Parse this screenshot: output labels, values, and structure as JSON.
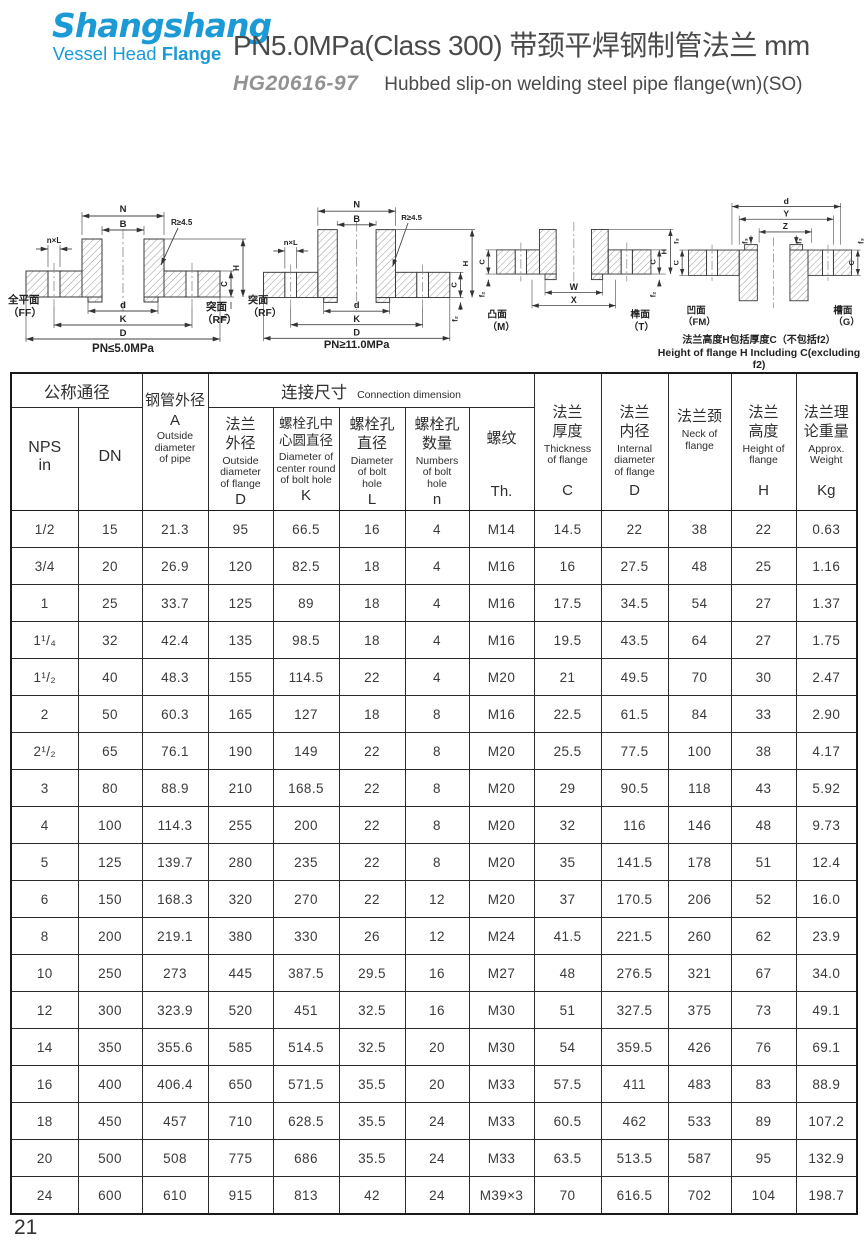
{
  "page": {
    "number": "21"
  },
  "header": {
    "logo_line1": "Shangshang",
    "logo_line2_a": "Vessel Head ",
    "logo_line2_b": "Flange",
    "logo_color": "#1b9ad6",
    "title": "PN5.0MPa(Class 300) 带颈平焊钢制管法兰  mm",
    "standard": "HG20616-97",
    "subtitle": "Hubbed slip-on welding steel pipe flange(wn)(SO)"
  },
  "figures": {
    "fig1": {
      "dim_N": "N",
      "dim_B": "B",
      "dim_nxL": "n×L",
      "dim_R": "R≥4.5",
      "dim_d": "d",
      "dim_K": "K",
      "dim_D": "D",
      "dim_C": "C",
      "dim_H": "H",
      "dim_f": "f₁",
      "face_left_cn": "全平面",
      "face_left_code": "（FF）",
      "face_right_cn": "突面",
      "face_right_code": "（RF）",
      "caption": "PN≤5.0MPa"
    },
    "fig2": {
      "dim_N": "N",
      "dim_B": "B",
      "dim_nxL": "n×L",
      "dim_R": "R≥4.5",
      "dim_d": "d",
      "dim_K": "K",
      "dim_D": "D",
      "dim_C": "C",
      "dim_H": "H",
      "dim_f": "f₂",
      "face_left_cn": "突面",
      "face_left_code": "（RF）",
      "caption": "PN≥11.0MPa"
    },
    "fig3": {
      "dim_W": "W",
      "dim_X": "X",
      "dim_C": "C",
      "dim_H": "H",
      "dim_f": "f₂",
      "face_left_cn": "凸面",
      "face_left_code": "（M）",
      "face_right_cn": "榫面",
      "face_right_code": "（T）"
    },
    "fig4": {
      "dim_d": "d",
      "dim_Y": "Y",
      "dim_Z": "Z",
      "dim_C": "C",
      "dim_f": "f₃",
      "face_left_cn": "凹面",
      "face_left_code": "（FM）",
      "face_right_cn": "槽面",
      "face_right_code": "（G）",
      "note_cn": "法兰高度H包括厚度C（不包括f2）",
      "note_en": "Height of flange H Including C(excluding f2)"
    }
  },
  "table": {
    "group_nominal": "公称通径",
    "group_connection_cn": "连接尺寸",
    "group_connection_en": "Connection dimension",
    "nps_l1": "NPS",
    "nps_l2": "in",
    "dn": "DN",
    "pipe_cn": "钢管外径",
    "pipe_sym": "A",
    "pipe_en": "Outside\ndiameter\nof pipe",
    "flange_od_cn": "法兰\n外径",
    "flange_od_en": "Outside\ndiameter\nof flange",
    "flange_od_sym": "D",
    "bolt_circle_cn": "螺栓孔中\n心圆直径",
    "bolt_circle_en": "Diameter of\ncenter round\nof bolt hole",
    "bolt_circle_sym": "K",
    "bolt_hole_cn": "螺栓孔\n直径",
    "bolt_hole_en": "Diameter\nof bolt\nhole",
    "bolt_hole_sym": "L",
    "bolt_num_cn": "螺栓孔\n数量",
    "bolt_num_en": "Numbers\nof bolt\nhole",
    "bolt_num_sym": "n",
    "thread_cn": "螺纹",
    "thread_sym": "Th.",
    "thickness_cn": "法兰\n厚度",
    "thickness_en": "Thickness\nof flange",
    "thickness_sym": "C",
    "inner_cn": "法兰\n内径",
    "inner_en": "Internal\ndiameter\nof flange",
    "inner_sym": "D",
    "neck_cn": "法兰颈",
    "neck_en": "Neck of\nflange",
    "height_cn": "法兰\n高度",
    "height_en": "Height of\nflange",
    "height_sym": "H",
    "weight_cn": "法兰理\n论重量",
    "weight_en": "Approx.\nWeight",
    "weight_sym": "Kg",
    "rows": [
      [
        "1/2",
        "15",
        "21.3",
        "95",
        "66.5",
        "16",
        "4",
        "M14",
        "14.5",
        "22",
        "38",
        "22",
        "0.63"
      ],
      [
        "3/4",
        "20",
        "26.9",
        "120",
        "82.5",
        "18",
        "4",
        "M16",
        "16",
        "27.5",
        "48",
        "25",
        "1.16"
      ],
      [
        "1",
        "25",
        "33.7",
        "125",
        "89",
        "18",
        "4",
        "M16",
        "17.5",
        "34.5",
        "54",
        "27",
        "1.37"
      ],
      [
        "1¹/₄",
        "32",
        "42.4",
        "135",
        "98.5",
        "18",
        "4",
        "M16",
        "19.5",
        "43.5",
        "64",
        "27",
        "1.75"
      ],
      [
        "1¹/₂",
        "40",
        "48.3",
        "155",
        "114.5",
        "22",
        "4",
        "M20",
        "21",
        "49.5",
        "70",
        "30",
        "2.47"
      ],
      [
        "2",
        "50",
        "60.3",
        "165",
        "127",
        "18",
        "8",
        "M16",
        "22.5",
        "61.5",
        "84",
        "33",
        "2.90"
      ],
      [
        "2¹/₂",
        "65",
        "76.1",
        "190",
        "149",
        "22",
        "8",
        "M20",
        "25.5",
        "77.5",
        "100",
        "38",
        "4.17"
      ],
      [
        "3",
        "80",
        "88.9",
        "210",
        "168.5",
        "22",
        "8",
        "M20",
        "29",
        "90.5",
        "118",
        "43",
        "5.92"
      ],
      [
        "4",
        "100",
        "114.3",
        "255",
        "200",
        "22",
        "8",
        "M20",
        "32",
        "116",
        "146",
        "48",
        "9.73"
      ],
      [
        "5",
        "125",
        "139.7",
        "280",
        "235",
        "22",
        "8",
        "M20",
        "35",
        "141.5",
        "178",
        "51",
        "12.4"
      ],
      [
        "6",
        "150",
        "168.3",
        "320",
        "270",
        "22",
        "12",
        "M20",
        "37",
        "170.5",
        "206",
        "52",
        "16.0"
      ],
      [
        "8",
        "200",
        "219.1",
        "380",
        "330",
        "26",
        "12",
        "M24",
        "41.5",
        "221.5",
        "260",
        "62",
        "23.9"
      ],
      [
        "10",
        "250",
        "273",
        "445",
        "387.5",
        "29.5",
        "16",
        "M27",
        "48",
        "276.5",
        "321",
        "67",
        "34.0"
      ],
      [
        "12",
        "300",
        "323.9",
        "520",
        "451",
        "32.5",
        "16",
        "M30",
        "51",
        "327.5",
        "375",
        "73",
        "49.1"
      ],
      [
        "14",
        "350",
        "355.6",
        "585",
        "514.5",
        "32.5",
        "20",
        "M30",
        "54",
        "359.5",
        "426",
        "76",
        "69.1"
      ],
      [
        "16",
        "400",
        "406.4",
        "650",
        "571.5",
        "35.5",
        "20",
        "M33",
        "57.5",
        "411",
        "483",
        "83",
        "88.9"
      ],
      [
        "18",
        "450",
        "457",
        "710",
        "628.5",
        "35.5",
        "24",
        "M33",
        "60.5",
        "462",
        "533",
        "89",
        "107.2"
      ],
      [
        "20",
        "500",
        "508",
        "775",
        "686",
        "35.5",
        "24",
        "M33",
        "63.5",
        "513.5",
        "587",
        "95",
        "132.9"
      ],
      [
        "24",
        "600",
        "610",
        "915",
        "813",
        "42",
        "24",
        "M39×3",
        "70",
        "616.5",
        "702",
        "104",
        "198.7"
      ]
    ]
  }
}
